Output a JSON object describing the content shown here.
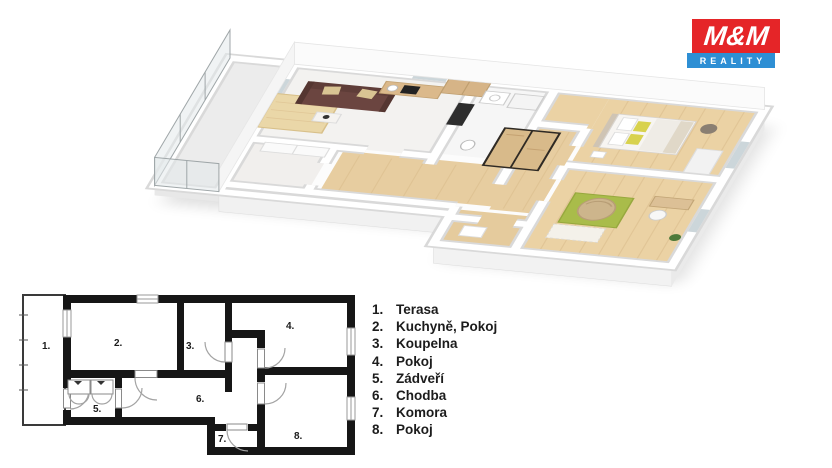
{
  "logo": {
    "title": "M&M",
    "subtitle": "REALITY"
  },
  "legend": {
    "items": [
      {
        "num": "1.",
        "label": "Terasa"
      },
      {
        "num": "2.",
        "label": "Kuchyně, Pokoj"
      },
      {
        "num": "3.",
        "label": "Koupelna"
      },
      {
        "num": "4.",
        "label": "Pokoj"
      },
      {
        "num": "5.",
        "label": "Zádveří"
      },
      {
        "num": "6.",
        "label": "Chodba"
      },
      {
        "num": "7.",
        "label": "Komora"
      },
      {
        "num": "8.",
        "label": "Pokoj"
      }
    ]
  },
  "colors": {
    "logo_red": "#e52528",
    "logo_blue": "#2e8fd4",
    "wall_black": "#161616",
    "wood_floor": "#e9d0a2",
    "rug_green": "#a9bc4a",
    "rug_beige": "#ead7a8",
    "sofa_brown": "#6b4540",
    "pillow_yellow": "#d8d24e"
  }
}
